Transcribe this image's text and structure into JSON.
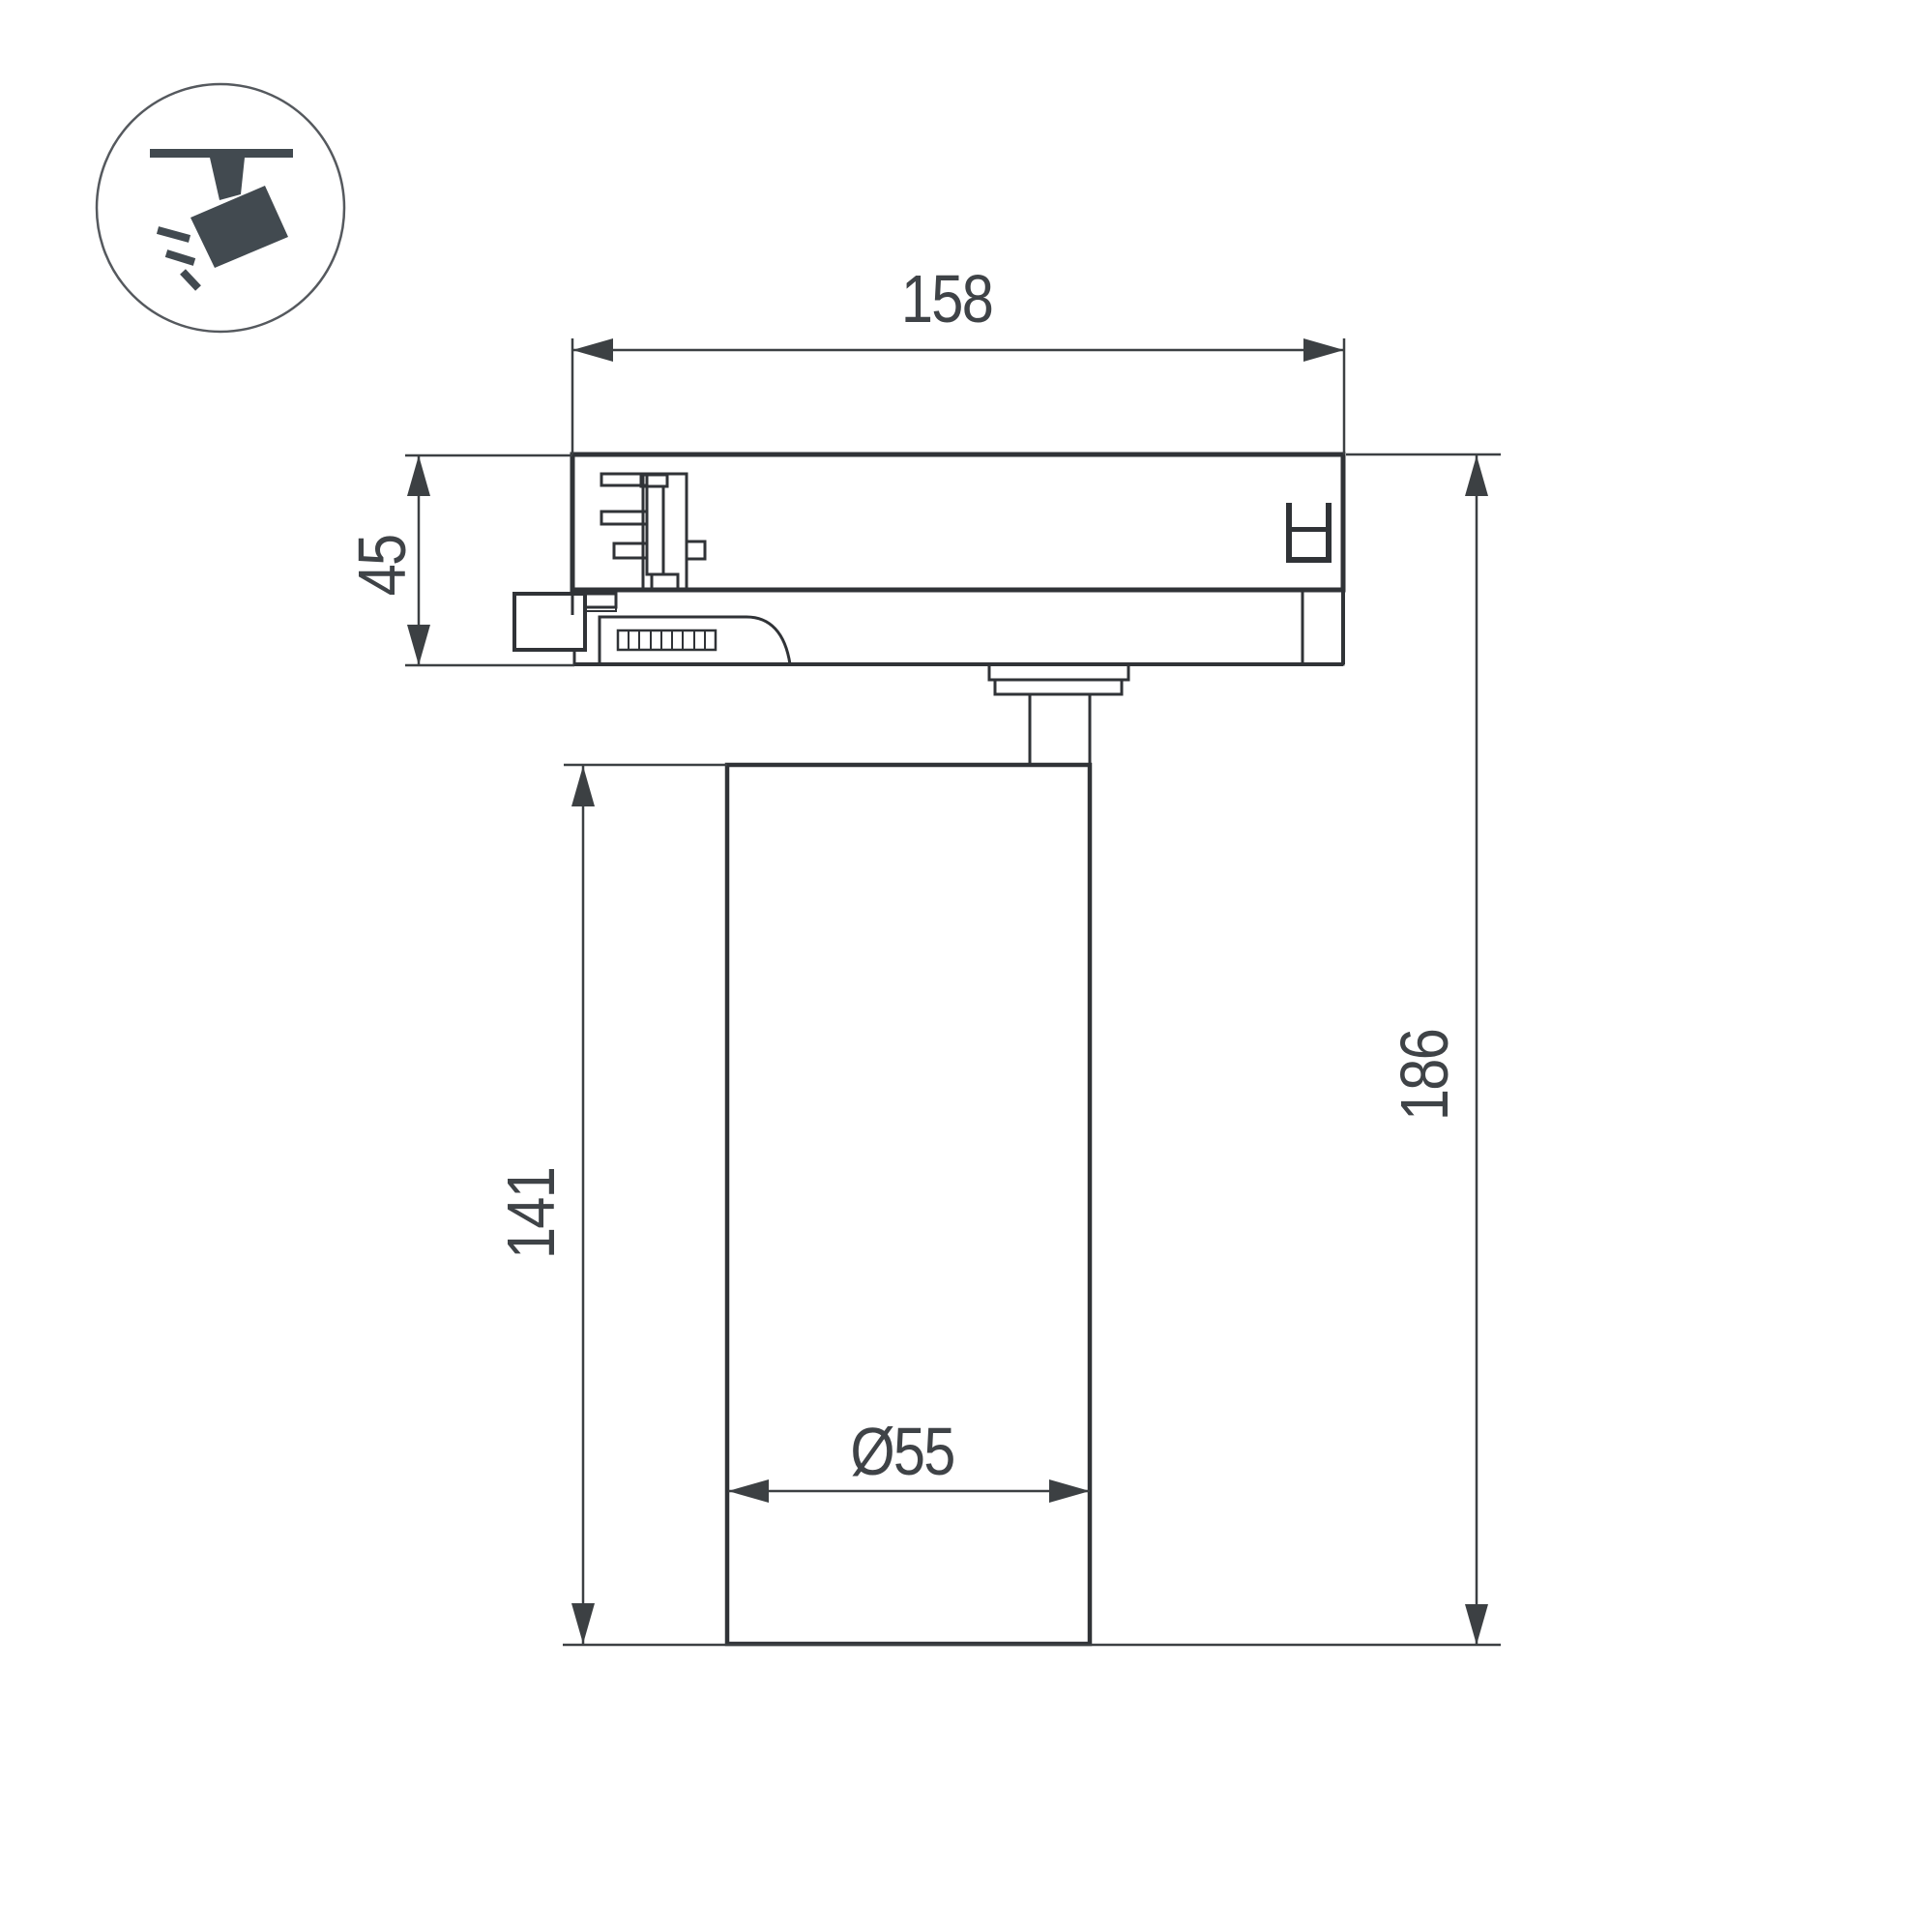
{
  "page": {
    "background": "#ffffff"
  },
  "icon": {
    "name": "ceiling-track-spotlight-pictogram",
    "color": "#424a50",
    "circle_stroke": "#55595e"
  },
  "drawing": {
    "type": "technical-dimension-drawing",
    "subject": "track-mounted LED spotlight, side view with track adapter",
    "line_color": "#35383c",
    "dimension_color": "#3f4347",
    "dimensions": {
      "adapter_width": "158",
      "adapter_height": "45",
      "body_height": "141",
      "total_height": "186",
      "body_diameter": "Ø55"
    }
  }
}
